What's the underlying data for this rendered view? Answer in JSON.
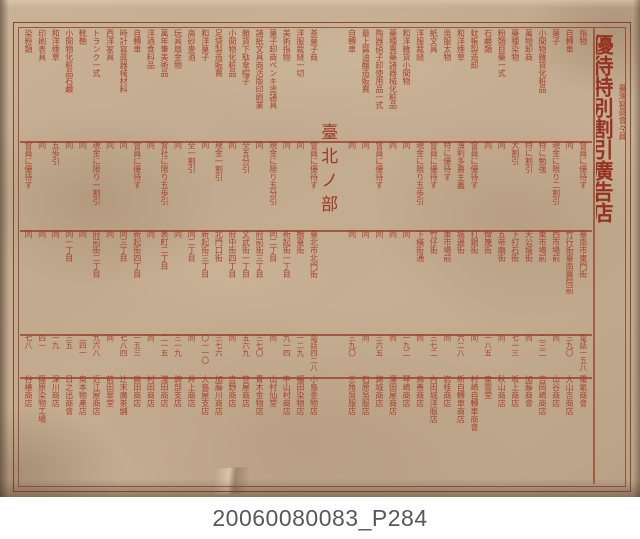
{
  "photo": {
    "caption": "20060080083_P284",
    "ink_color": "#a43a24",
    "paper_color": "#c2aa8e"
  },
  "title": {
    "association": "臺灣寫眞會々員",
    "main": "優待特別割引廣告店",
    "note": "（必ず會員證持參の事）"
  },
  "columns": [
    {
      "goods": "指物",
      "terms": "會員に優待す",
      "address": "臺南市東門街",
      "phone": "電話一五八",
      "name": "電氣商會"
    },
    {
      "goods": "自轉車",
      "terms": "同",
      "address": "竹行街臺南醫院前",
      "phone": "三九〇",
      "name": "大山吉商店"
    },
    {
      "goods": "菓子",
      "terms": "現金に限り二割引",
      "address": "西市場前",
      "phone": "同",
      "name": "山谷商店"
    },
    {
      "goods": "小間物雜貨化粧品",
      "terms": "特に勉強",
      "address": "東市場前",
      "phone": "二三二",
      "name": "吉岡崎商店"
    },
    {
      "goods": "萬物卸商",
      "terms": "特に割引",
      "address": "天公壇街",
      "phone": "同",
      "name": "加藤商會"
    },
    {
      "goods": "藥種染物",
      "terms": "大割引",
      "address": "下打石街",
      "phone": "七一三",
      "name": "坂上商店"
    },
    {
      "goods": "粉類目藥一式",
      "terms": "同",
      "address": "五帝廟街",
      "phone": "同",
      "name": "秋山商店"
    },
    {
      "goods": "石鹸類",
      "terms": "同",
      "address": "做篾街",
      "phone": "一八五",
      "name": "東雲堂"
    },
    {
      "goods": "蚊帳製造卸",
      "terms": "會員に優待す",
      "address": "打銀街",
      "phone": "同",
      "name": "村崎自轉車商會"
    },
    {
      "goods": "和洋煙草",
      "terms": "薄利多賣主義",
      "address": "城邊街",
      "phone": "六二八",
      "name": "新自轉車商店"
    },
    {
      "goods": "吳服太物",
      "terms": "特に優待す",
      "address": "東市場前",
      "phone": "同",
      "name": "岩桂商店"
    },
    {
      "goods": "紙文具",
      "terms": "會員に優待す",
      "address": "竹仔街",
      "phone": "三七二",
      "name": "內田城洋服店"
    },
    {
      "goods": "洋服裁縫",
      "terms": "現金に限り五歩引",
      "address": "下橫街通",
      "phone": "同",
      "name": "鳥善商店"
    },
    {
      "goods": "和洋雜貨小間物",
      "terms": "同",
      "address": "同",
      "phone": "一九二",
      "name": "琴崎商店"
    },
    {
      "goods": "藥種賣藥諸器械化粧品",
      "terms": "同",
      "address": "同",
      "phone": "同",
      "name": "澤田屋商店"
    },
    {
      "goods": "陶器硝子卸使用品一式",
      "terms": "會員に優待す",
      "address": "同",
      "phone": "三六五",
      "name": "錦城商店"
    },
    {
      "goods": "最上醤油釀造販賣",
      "terms": "同",
      "address": "同",
      "phone": "同",
      "name": "石原吳服店"
    },
    {
      "goods": "自轉車",
      "terms": "同",
      "address": "同",
      "phone": "三九〇",
      "name": "三角吳服店"
    },
    {
      "divider": "臺北ノ部"
    },
    {
      "goods": "茶菓子商",
      "terms": "會員に優待す",
      "address": "臺北市北門街",
      "phone": "電話四二八",
      "name": "小島金物店"
    },
    {
      "goods": "洋服裁縫一切",
      "terms": "同",
      "address": "撫臺街",
      "phone": "一二九",
      "name": "福田染物店"
    },
    {
      "goods": "美術指物",
      "terms": "同",
      "address": "新起街一丁目",
      "phone": "九一四",
      "name": "中山村商店"
    },
    {
      "goods": "菓子卸商ペンキ塗諸具",
      "terms": "現金に限り五分引",
      "address": "同二丁目",
      "phone": "同",
      "name": "山村仙堂"
    },
    {
      "goods": "諸紙文具商活版印刷業",
      "terms": "同",
      "address": "府前街三丁目",
      "phone": "三七〇",
      "name": "青木金物店"
    },
    {
      "goods": "雜貨下駄傘帽子",
      "terms": "全五分引",
      "address": "文武街一丁目",
      "phone": "五六九",
      "name": "笹屋商店"
    },
    {
      "goods": "小間物化粧品",
      "terms": "同",
      "address": "府中街四丁目",
      "phone": "同",
      "name": "吉野商店"
    },
    {
      "goods": "足袋製造販賣",
      "terms": "現金一割引",
      "address": "北門口街",
      "phone": "三七六",
      "name": "加藤川商店"
    },
    {
      "goods": "和洋菓子",
      "terms": "同",
      "address": "新起街三丁目",
      "phone": "〇一一〇",
      "name": "大島屋支店"
    },
    {
      "goods": "高砂麥酒",
      "terms": "全一割引",
      "address": "同二丁目",
      "phone": "同",
      "name": "井上商店"
    },
    {
      "goods": "玩具扇金物",
      "terms": "同",
      "address": "同",
      "phone": "三一九",
      "name": "錦部支店"
    },
    {
      "goods": "萬年筆美術品",
      "terms": "會社に限り五歩引",
      "address": "表町二丁目",
      "phone": "二一五",
      "name": "淺田商店"
    },
    {
      "goods": "洋酒食料品",
      "terms": "同",
      "address": "同",
      "phone": "同",
      "name": "村田商店"
    },
    {
      "goods": "自轉車",
      "terms": "會員に優待す",
      "address": "新起街四丁目",
      "phone": "一五三",
      "name": "高田商店"
    },
    {
      "goods": "時計寫眞器械材料",
      "terms": "同",
      "address": "同三丁目",
      "phone": "七八四",
      "name": "辻末廣茶舖"
    },
    {
      "goods": "西洋家具",
      "terms": "同",
      "address": "同",
      "phone": "同",
      "name": "前田翠堂"
    },
    {
      "goods": "トランク一式",
      "terms": "現金に限り一割引",
      "address": "府前街二丁目",
      "phone": "九六八",
      "name": "近江屋商店"
    },
    {
      "goods": "靴鞄",
      "terms": "同",
      "address": "同",
      "phone": "二四一",
      "name": "奥本物產店"
    },
    {
      "goods": "小間物化粧品石鹸",
      "terms": "同",
      "address": "同一丁目",
      "phone": "三五",
      "name": "日之出商會"
    },
    {
      "goods": "和洋煙草",
      "terms": "五歩引",
      "address": "同",
      "phone": "一九",
      "name": "深川商店"
    },
    {
      "goods": "印刷表具",
      "terms": "同",
      "address": "同",
      "phone": "四一",
      "name": "篠原染物工場"
    },
    {
      "goods": "染粉類",
      "terms": "會員に優待す",
      "address": "同",
      "phone": "七八",
      "name": "谷椿商店"
    }
  ]
}
